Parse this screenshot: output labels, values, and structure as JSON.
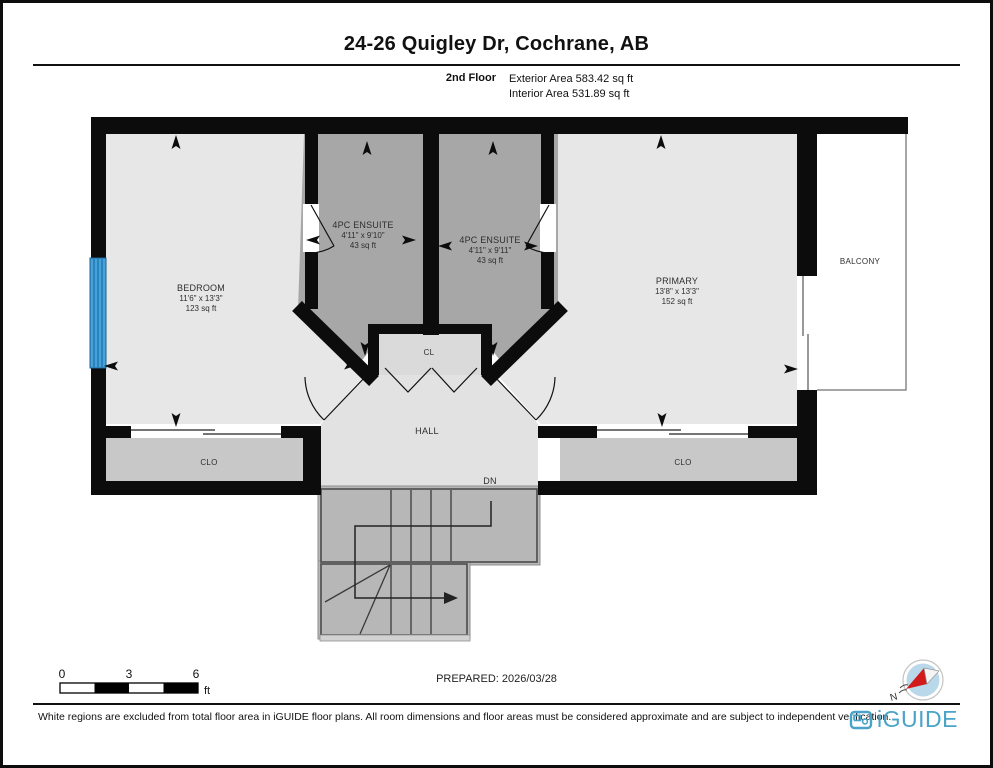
{
  "header": {
    "title": "24-26 Quigley Dr, Cochrane, AB",
    "floor_label": "2nd Floor",
    "exterior_area": "Exterior Area 583.42 sq ft",
    "interior_area": "Interior Area 531.89 sq ft"
  },
  "rooms": {
    "bedroom": {
      "name": "BEDROOM",
      "dims": "11'6\" x 13'3\"",
      "area": "123 sq ft"
    },
    "ensuite1": {
      "name": "4PC ENSUITE",
      "dims": "4'11\" x 9'10\"",
      "area": "43 sq ft"
    },
    "ensuite2": {
      "name": "4PC ENSUITE",
      "dims": "4'11\" x 9'11\"",
      "area": "43 sq ft"
    },
    "primary": {
      "name": "PRIMARY",
      "dims": "13'8\" x 13'3\"",
      "area": "152 sq ft"
    },
    "balcony": {
      "name": "BALCONY"
    },
    "closet_center": {
      "name": "CL"
    },
    "hall": {
      "name": "HALL"
    },
    "closet_left": {
      "name": "CLO"
    },
    "closet_right": {
      "name": "CLO"
    },
    "stairs": {
      "label": "DN"
    }
  },
  "scale_bar": {
    "tick0": "0",
    "tick1": "3",
    "tick2": "6",
    "unit": "ft"
  },
  "footer": {
    "prepared": "PREPARED: 2026/03/28",
    "compass_label": "N",
    "disclaimer": "White regions are excluded from total floor area in iGUIDE floor plans. All room dimensions and floor areas must be considered approximate and are subject to independent verification.",
    "brand": "iGUIDE"
  },
  "colors": {
    "wall": "#0c0c0c",
    "room_light": "#e7e7e7",
    "ensuite_gray": "#a7a7a7",
    "closet_gray": "#c8c8c8",
    "stairs_gray": "#b7b7b7",
    "window_blue": "#46a2d9",
    "brand_blue": "#4aa3c9",
    "compass_fill": "#b9d8ea",
    "compass_red": "#d11a1a"
  }
}
